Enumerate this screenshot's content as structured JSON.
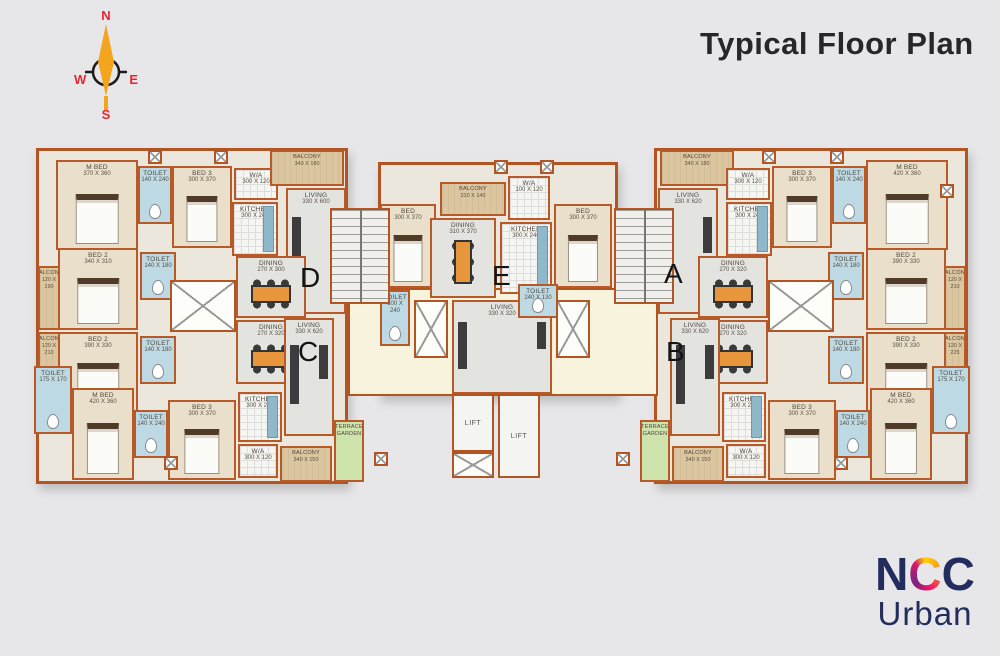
{
  "title": "Typical Floor Plan",
  "compass": {
    "n": "N",
    "e": "E",
    "s": "S",
    "w": "W"
  },
  "logo": {
    "n1": "N",
    "c1": "C",
    "c2": "C",
    "line2": "Urban"
  },
  "common": {
    "lift": "LIFT"
  },
  "units": {
    "d": {
      "letter": "D",
      "rooms": {
        "mbed": {
          "name": "M BED",
          "dims": "370 X 360"
        },
        "toilet_m": {
          "name": "TOILET",
          "dims": "140 X 240"
        },
        "bed3": {
          "name": "BED 3",
          "dims": "300 X 370"
        },
        "wa": {
          "name": "W/A",
          "dims": "300 X 120"
        },
        "kitchen": {
          "name": "KITCHEN",
          "dims": "300 X 240"
        },
        "balcony_top": {
          "name": "BALCONY",
          "dims": "340 X 180"
        },
        "living": {
          "name": "LIVING",
          "dims": "330 X 600"
        },
        "dining": {
          "name": "DINING",
          "dims": "270 X 300"
        },
        "bed2": {
          "name": "BED 2",
          "dims": "340 X 310"
        },
        "toilet2": {
          "name": "TOILET",
          "dims": "140 X 180"
        },
        "balcony_side": {
          "name": "BALCONY",
          "dims": "120 X 190"
        }
      }
    },
    "c": {
      "letter": "C",
      "rooms": {
        "bed2": {
          "name": "BED 2",
          "dims": "390 X 330"
        },
        "toilet2": {
          "name": "TOILET",
          "dims": "140 X 180"
        },
        "balcony_side": {
          "name": "BALCONY",
          "dims": "120 X 210"
        },
        "toilet_corner": {
          "name": "TOILET",
          "dims": "175 X 170"
        },
        "mbed": {
          "name": "M BED",
          "dims": "420 X 360"
        },
        "toilet_m": {
          "name": "TOILET",
          "dims": "140 X 240"
        },
        "bed3": {
          "name": "BED 3",
          "dims": "300 X 370"
        },
        "dining": {
          "name": "DINING",
          "dims": "270 X 320"
        },
        "living": {
          "name": "LIVING",
          "dims": "330 X 620"
        },
        "kitchen": {
          "name": "KITCHEN",
          "dims": "300 X 240"
        },
        "wa": {
          "name": "W/A",
          "dims": "300 X 120"
        },
        "balcony_bottom": {
          "name": "BALCONY",
          "dims": "340 X 150"
        },
        "terrace": {
          "name": "TERRACE GARDEN",
          "dims": ""
        }
      }
    },
    "e": {
      "letter": "E",
      "rooms": {
        "balcony": {
          "name": "BALCONY",
          "dims": "310 X 140"
        },
        "wa": {
          "name": "W/A",
          "dims": "100 X 120"
        },
        "kitchen": {
          "name": "KITCHEN",
          "dims": "300 X 240"
        },
        "dining": {
          "name": "DINING",
          "dims": "310 X 370"
        },
        "bed_left": {
          "name": "BED",
          "dims": "300 X 370"
        },
        "bed_right": {
          "name": "BED",
          "dims": "300 X 370"
        },
        "living": {
          "name": "LIVING",
          "dims": "330 X 320"
        },
        "toilet_left": {
          "name": "TOILET",
          "dims": "100 X 240"
        },
        "toilet_right": {
          "name": "TOILET",
          "dims": "240 X 130"
        }
      }
    },
    "a": {
      "letter": "A",
      "rooms": {
        "balcony_top": {
          "name": "BALCONY",
          "dims": "340 X 180"
        },
        "living": {
          "name": "LIVING",
          "dims": "330 X 620"
        },
        "wa": {
          "name": "W/A",
          "dims": "300 X 120"
        },
        "kitchen": {
          "name": "KITCHEN",
          "dims": "300 X 240"
        },
        "bed3": {
          "name": "BED 3",
          "dims": "300 X 370"
        },
        "toilet_m": {
          "name": "TOILET",
          "dims": "140 X 240"
        },
        "mbed": {
          "name": "M BED",
          "dims": "420 X 360"
        },
        "bed2": {
          "name": "BED 2",
          "dims": "390 X 330"
        },
        "toilet2": {
          "name": "TOILET",
          "dims": "140 X 180"
        },
        "balcony_side": {
          "name": "BALCONY",
          "dims": "120 X 210"
        },
        "dining": {
          "name": "DINING",
          "dims": "270 X 320"
        }
      }
    },
    "b": {
      "letter": "B",
      "rooms": {
        "bed2": {
          "name": "BED 2",
          "dims": "390 X 330"
        },
        "toilet2": {
          "name": "TOILET",
          "dims": "140 X 180"
        },
        "balcony_side": {
          "name": "BALCONY",
          "dims": "120 X 225"
        },
        "toilet_corner": {
          "name": "TOILET",
          "dims": "175 X 170"
        },
        "mbed": {
          "name": "M BED",
          "dims": "420 X 360"
        },
        "toilet_m": {
          "name": "TOILET",
          "dims": "140 X 240"
        },
        "bed3": {
          "name": "BED 3",
          "dims": "300 X 370"
        },
        "dining": {
          "name": "DINING",
          "dims": "270 X 320"
        },
        "living": {
          "name": "LIVING",
          "dims": "330 X 620"
        },
        "kitchen": {
          "name": "KITCHEN",
          "dims": "300 X 240"
        },
        "wa": {
          "name": "W/A",
          "dims": "300 X 120"
        },
        "balcony_bottom": {
          "name": "BALCONY",
          "dims": "340 X 150"
        },
        "terrace": {
          "name": "TERRACE GARDEN",
          "dims": ""
        }
      }
    }
  }
}
